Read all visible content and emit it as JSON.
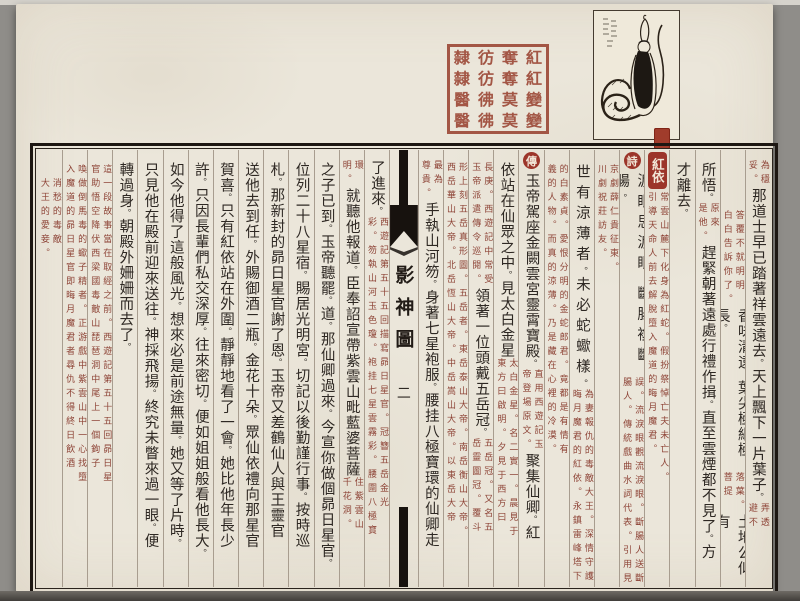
{
  "book": {
    "title": "影神圖",
    "page_number": "二",
    "entry_title": "紅依",
    "poem_badge": "詩",
    "biography_badge": "傳"
  },
  "colors": {
    "parchment": "#ebe6da",
    "ink": "#2e2823",
    "commentary_red": "#8e4437",
    "badge_red": "#9c352a",
    "seal_red": "#9d4a39",
    "border_black": "#1d1712"
  },
  "seal": {
    "rows": [
      [
        "隸",
        "彷",
        "奪",
        "紅"
      ],
      [
        "隸",
        "彷",
        "奪",
        "紅"
      ],
      [
        "醫",
        "彿",
        "莫",
        "變"
      ],
      [
        "醫",
        "彿",
        "莫",
        "變"
      ]
    ]
  },
  "columns": [
    {
      "id": "R1",
      "segs": [
        {
          "t": "sp",
          "h": 10
        },
        {
          "t": "note",
          "r": "為穩",
          "l": "妥。"
        },
        {
          "t": "big",
          "x": "那道士早已踏著祥雲遠去。天上飄下一片葉子。"
        },
        {
          "t": "note",
          "r": "弄透",
          "l": "避不"
        }
      ]
    },
    {
      "id": "R2",
      "segs": [
        {
          "t": "sp",
          "h": 60
        },
        {
          "t": "note",
          "r": "答覆不就明明",
          "l": "白白告訴你了。"
        },
        {
          "t": "big",
          "x": "香味清遠。葉尖極細極長。"
        },
        {
          "t": "note",
          "r": "落葉。",
          "l": "菩提"
        },
        {
          "t": "big",
          "x": "土地公似有"
        }
      ]
    },
    {
      "id": "R3",
      "segs": [
        {
          "t": "sp",
          "h": 12
        },
        {
          "t": "big",
          "x": "所悟。"
        },
        {
          "t": "note",
          "r": "原來",
          "l": "是他。"
        },
        {
          "t": "big",
          "x": "趕緊朝著遠處行禮作揖。直至雲煙都不見了。方"
        }
      ]
    },
    {
      "id": "R4",
      "segs": [
        {
          "t": "sp",
          "h": 12
        },
        {
          "t": "big",
          "x": "才離去。"
        }
      ]
    },
    {
      "id": "R5",
      "segs": [
        {
          "t": "sp",
          "h": 2
        },
        {
          "t": "badge",
          "shape": "rect",
          "x": "紅依"
        },
        {
          "t": "note",
          "r": "常雲山麓下化身為紅蛇。假扮祭悼亡夫未亡人。",
          "l": "引導天命人前去解脫墮入魔道的晦月魔君。"
        }
      ]
    },
    {
      "id": "R6",
      "segs": [
        {
          "t": "sp",
          "h": 2
        },
        {
          "t": "badge",
          "shape": "circle",
          "x": "詩"
        },
        {
          "t": "big",
          "sparse": true,
          "x": "淚眼思淚眼。斷腸複斷腸。"
        },
        {
          "t": "note",
          "r": "誤。流淚眼觀流淚眼。斷腸人送斷",
          "l": "腸人。傳統戲曲水詞代表。引用見"
        }
      ]
    },
    {
      "id": "R7",
      "segs": [
        {
          "t": "sp",
          "h": 14
        },
        {
          "t": "note",
          "r": "京劇薛仁貴征東。",
          "l": "川劇祝莊訪友。"
        }
      ]
    },
    {
      "id": "R8",
      "segs": [
        {
          "t": "sp",
          "h": 14
        },
        {
          "t": "big",
          "sparse": true,
          "x": "世有涼薄者。未必蛇蠍樣。"
        },
        {
          "t": "note",
          "r": "為妻報仇的毒敵大王。深情守護",
          "l": "晦月魔君的紅依。永鎮雷峰塔下"
        }
      ]
    },
    {
      "id": "R9",
      "segs": [
        {
          "t": "sp",
          "h": 14
        },
        {
          "t": "note",
          "r": "的白素貞。愛恨分明的金蛇郎君。竟都是有情有",
          "l": "義的人物。而真的涼薄。乃是藏在心裡的冷漠。"
        }
      ]
    },
    {
      "id": "R10",
      "segs": [
        {
          "t": "sp",
          "h": 2
        },
        {
          "t": "badge",
          "shape": "circle",
          "x": "傳"
        },
        {
          "t": "big",
          "x": "玉帝駕座金闕雲宮靈霄寶殿。"
        },
        {
          "t": "note",
          "r": "直用西遊記玉",
          "l": "帝登場原文。"
        },
        {
          "t": "big",
          "x": "聚集仙卿。紅"
        }
      ]
    },
    {
      "id": "R11",
      "segs": [
        {
          "t": "sp",
          "h": 12
        },
        {
          "t": "big",
          "x": "依站在仙眾之中。見太白金星"
        },
        {
          "t": "note",
          "r": "太白金星。名二實一。晨見于",
          "l": "東方曰啟明。夕見于西方曰"
        }
      ]
    },
    {
      "id": "R12",
      "segs": [
        {
          "t": "sp",
          "h": 12
        },
        {
          "t": "note",
          "r": "長庚。西遊記中常受",
          "l": "玉帝派遣傳令巡閱。"
        },
        {
          "t": "big",
          "x": "領著一位頭戴五岳冠。"
        },
        {
          "t": "note",
          "r": "五岳冠。又名五",
          "l": "岳靈圖冠。覆斗"
        }
      ]
    },
    {
      "id": "R13",
      "segs": [
        {
          "t": "sp",
          "h": 12
        },
        {
          "t": "note",
          "r": "形上刻五岳真形圖。五岳者。東岳泰山大帝。南岳衡山大帝。",
          "l": "西岳華山大帝。北岳恆山大帝。中岳嵩山大帝。以東岳大帝"
        }
      ]
    },
    {
      "id": "R14",
      "segs": [
        {
          "t": "sp",
          "h": 10
        },
        {
          "t": "note",
          "r": "最為",
          "l": "尊貴。"
        },
        {
          "t": "big",
          "x": "手執山河笏。身著七星袍服。腰挂八極寶環的仙卿走"
        }
      ]
    },
    {
      "id": "SPINE",
      "spine": true
    },
    {
      "id": "L1",
      "segs": [
        {
          "t": "sp",
          "h": 10
        },
        {
          "t": "big",
          "x": "了進來。"
        },
        {
          "t": "note",
          "r": "西遊記第五十五回描寫昴日星官。冠簪五岳金光",
          "l": "彩。笏執山河玉色瓊。袍挂七星雲霧彩。腰圍八極寶"
        }
      ]
    },
    {
      "id": "L2",
      "segs": [
        {
          "t": "sp",
          "h": 10
        },
        {
          "t": "note",
          "r": "環",
          "l": "明。"
        },
        {
          "t": "big",
          "x": "就聽他報道。臣奉詔宣帶紫雲山毗藍婆菩薩"
        },
        {
          "t": "note",
          "r": "住紫雲山",
          "l": "千花洞。"
        }
      ]
    },
    {
      "id": "L3",
      "segs": [
        {
          "t": "sp",
          "h": 12
        },
        {
          "t": "big",
          "x": "之子已到。玉帝聽罷。道。那仙卿過來。今宣你做個昴日星官。"
        }
      ]
    },
    {
      "id": "L4",
      "segs": [
        {
          "t": "sp",
          "h": 12
        },
        {
          "t": "big",
          "x": "位列二十八星宿。賜居光明宮。切記以後勤謹行事。按時巡"
        }
      ]
    },
    {
      "id": "L5",
      "segs": [
        {
          "t": "sp",
          "h": 12
        },
        {
          "t": "big",
          "x": "札。那新封的昴日星官謝了恩。玉帝又差鶴仙人與王靈官"
        }
      ]
    },
    {
      "id": "L6",
      "segs": [
        {
          "t": "sp",
          "h": 12
        },
        {
          "t": "big",
          "x": "送他去到任。外賜御酒二瓶。金花十朵。眾仙依禮向那星官"
        }
      ]
    },
    {
      "id": "L7",
      "segs": [
        {
          "t": "sp",
          "h": 12
        },
        {
          "t": "big",
          "x": "賀喜。只有紅依站在外圍。靜靜地看了一會。她比他年長少"
        }
      ]
    },
    {
      "id": "L8",
      "segs": [
        {
          "t": "sp",
          "h": 12
        },
        {
          "t": "big",
          "x": "許。只因長輩們私交深厚。往來密切。便如姐姐般看他長大。"
        }
      ]
    },
    {
      "id": "L9",
      "segs": [
        {
          "t": "sp",
          "h": 12
        },
        {
          "t": "big",
          "x": "如今他得了這般風光。想來必是前途無量。她又等了片時。"
        }
      ]
    },
    {
      "id": "L10",
      "segs": [
        {
          "t": "sp",
          "h": 12
        },
        {
          "t": "big",
          "x": "只見他在殿前迎來送往。神採飛揚。終究未瞥來過一眼。便"
        }
      ]
    },
    {
      "id": "L11",
      "segs": [
        {
          "t": "sp",
          "h": 12
        },
        {
          "t": "big",
          "x": "轉過身。朝殿外姍姍而去了。"
        }
      ]
    },
    {
      "id": "L12",
      "segs": [
        {
          "t": "sp",
          "h": 14
        },
        {
          "t": "note",
          "r": "這一段故事當在取經之前。西遊記第五十五回昴日星",
          "l": "官助悟空降伏西梁國毒敵山琵琶洞中尾上一個鉤子"
        }
      ]
    },
    {
      "id": "L13",
      "segs": [
        {
          "t": "sp",
          "h": 14
        },
        {
          "t": "note",
          "r": "喚做倒馬毒的蠍子精者。正游戲中紫雲山中一心找墮",
          "l": "入魔道的昴日星官即晦月魔君者尋仇不得終日飲酒"
        }
      ]
    },
    {
      "id": "L14",
      "segs": [
        {
          "t": "sp",
          "h": 28
        },
        {
          "t": "note",
          "r": "消愁的毒敵",
          "l": "大王的愛妾。"
        }
      ]
    }
  ]
}
